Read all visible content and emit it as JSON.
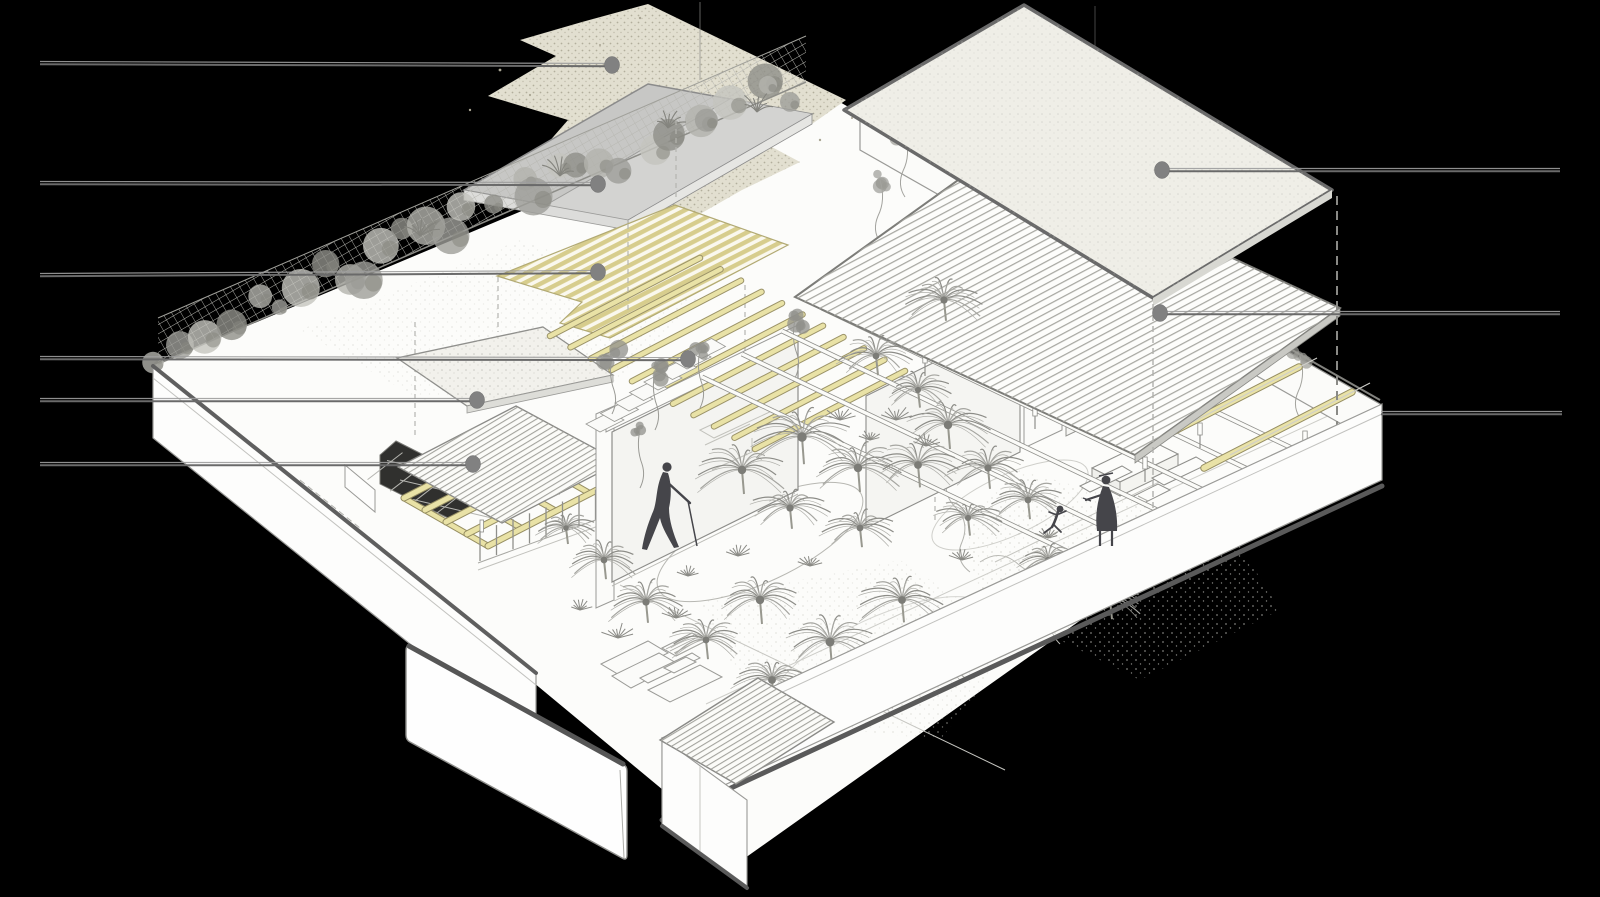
{
  "scene": {
    "kind": "exploded-axonometric-architecture-diagram",
    "background_color": "#000000",
    "has_text_labels": false,
    "subject": "courtyard-house-with-palm-garden"
  },
  "annotations": {
    "line_color_dark": "#6a6a6a",
    "line_color_light": "#9e9e9e",
    "dot_color": "#818181",
    "dot_rx": 7.5,
    "dot_ry": 8.5,
    "left_leaders": [
      {
        "y": 63,
        "x_start": 40,
        "dot_x": 612,
        "dot_y": 65,
        "points_to": "textured-ground-plane"
      },
      {
        "y": 183,
        "x_start": 40,
        "dot_x": 598,
        "dot_y": 184,
        "points_to": "concrete-roof-slab"
      },
      {
        "y": 275,
        "x_start": 40,
        "dot_x": 598,
        "dot_y": 272,
        "points_to": "louver-screen-plane"
      },
      {
        "y": 358,
        "x_start": 40,
        "dot_x": 688,
        "dot_y": 359,
        "points_to": "timber-rafters"
      },
      {
        "y": 400,
        "x_start": 40,
        "dot_x": 477,
        "dot_y": 400,
        "points_to": "entry-canopy"
      },
      {
        "y": 464,
        "x_start": 40,
        "dot_x": 473,
        "dot_y": 464,
        "points_to": "corrugated-canopy"
      }
    ],
    "right_leaders": [
      {
        "y": 170,
        "x_end": 1560,
        "dot_x": 1162,
        "dot_y": 170,
        "points_to": "primary-roof-plane"
      },
      {
        "y": 313,
        "x_end": 1560,
        "dot_x": 1160,
        "dot_y": 313,
        "points_to": "corrugated-roof-plane"
      },
      {
        "y": 413,
        "x_end": 1562,
        "dot_x": null,
        "dot_y": null,
        "x_start": 1381,
        "points_to": "perimeter-wall-corner"
      }
    ]
  },
  "palette": {
    "paper": "#fcfcfa",
    "beige_plane": "#e2dfd0",
    "beige_speckle": "#a9a593",
    "roof_slab": "#c7c7c5",
    "roof_slab_light": "#d3d3d1",
    "louver_yellow": "#d7cd8d",
    "trellis_yellow": "#e9e2a6",
    "trellis_edge": "#968e62",
    "primary_roof": "#efeee7",
    "primary_roof_border": "#6a6a6a",
    "corrugation_line": "#a8a8a2",
    "outline_gray": "#9a9a97",
    "shadow_gray": "#565656",
    "vegetation_gray": "#9a9a95",
    "skylight_dark": "#30302e",
    "figure_dark": "#45454a"
  },
  "figures": [
    {
      "name": "walking-person",
      "x": 667,
      "y": 505,
      "pose": "walking"
    },
    {
      "name": "standing-adult",
      "x": 1107,
      "y": 510,
      "pose": "standing-at-table"
    },
    {
      "name": "running-child",
      "x": 1058,
      "y": 518,
      "pose": "running"
    }
  ],
  "components": [
    "textured-ground-plane",
    "concrete-roof-slab",
    "louver-screen-plane",
    "primary-roof-plane",
    "corrugated-roof-plane",
    "green-wall-fence",
    "timber-trellis",
    "skylight-pergola",
    "entry-canopy",
    "corrugated-canopy",
    "perimeter-walls",
    "detached-gate-panel",
    "central-glass-pavilion",
    "right-glass-pavilion",
    "palm-garden",
    "lounge-furniture",
    "dining-table"
  ]
}
